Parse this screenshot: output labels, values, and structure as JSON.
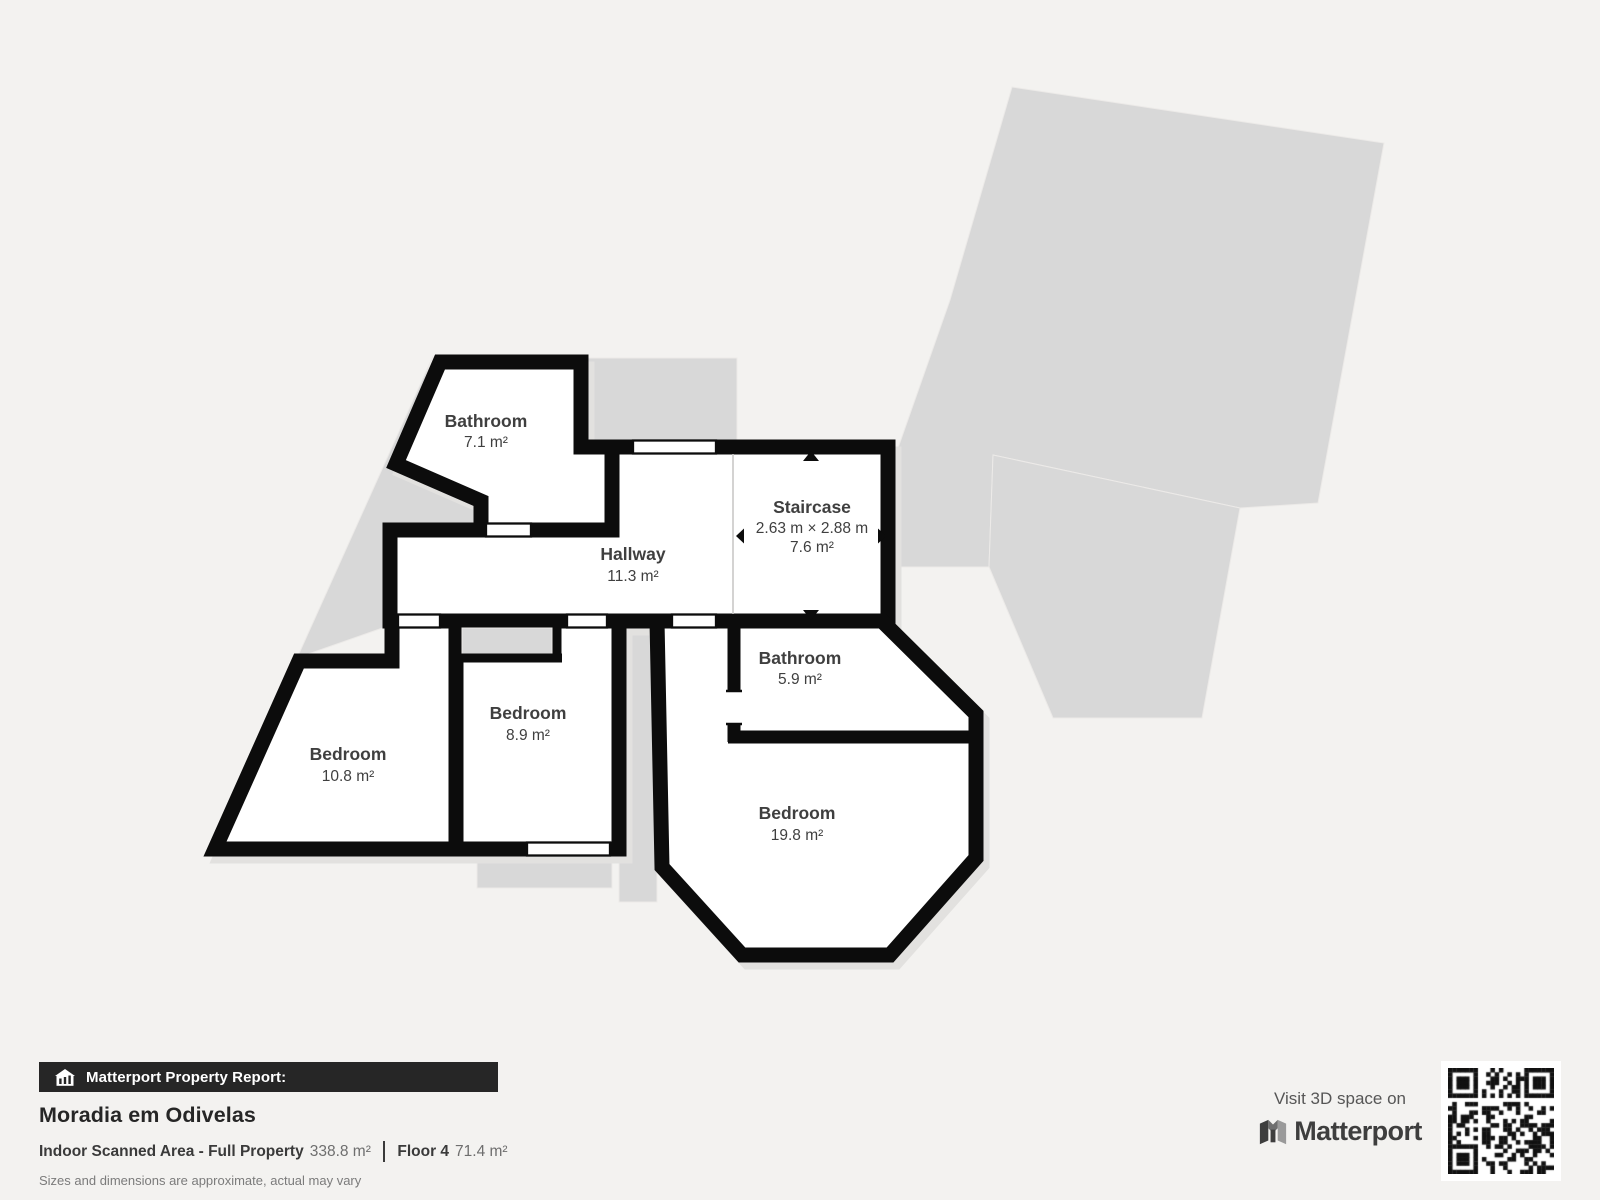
{
  "plan": {
    "rooms": {
      "bathroom_top": {
        "name": "Bathroom",
        "area": "7.1 m²"
      },
      "hallway": {
        "name": "Hallway",
        "area": "11.3 m²"
      },
      "staircase": {
        "name": "Staircase",
        "dims": "2.63 m × 2.88 m",
        "area": "7.6 m²"
      },
      "bathroom_mid": {
        "name": "Bathroom",
        "area": "5.9 m²"
      },
      "bedroom_left": {
        "name": "Bedroom",
        "area": "10.8 m²"
      },
      "bedroom_mid": {
        "name": "Bedroom",
        "area": "8.9 m²"
      },
      "bedroom_large": {
        "name": "Bedroom",
        "area": "19.8 m²"
      }
    }
  },
  "footer": {
    "report_bar": {
      "label": "Matterport Property Report:"
    },
    "property_title": "Moradia em Odivelas",
    "stats": {
      "scanned_label": "Indoor Scanned Area - Full Property",
      "scanned_value": "338.8 m²",
      "floor_label": "Floor 4",
      "floor_value": "71.4 m²"
    },
    "disclaimer": "Sizes and dimensions are approximate, actual may vary"
  },
  "promo": {
    "visit_text": "Visit 3D space on",
    "brand": "Matterport"
  },
  "colors": {
    "page_bg": "#f3f2f0",
    "silhouette": "#d8d8d8",
    "shadow": "#e2e1df",
    "wall": "#0c0c0c",
    "room_fill": "#ffffff",
    "label": "#3f3f3f",
    "bar_bg": "#262626",
    "bar_text": "#ffffff",
    "title": "#262626",
    "value_text": "#6e6e6e",
    "disclaimer": "#7b7b7b",
    "brand": "#3e3e3e"
  }
}
